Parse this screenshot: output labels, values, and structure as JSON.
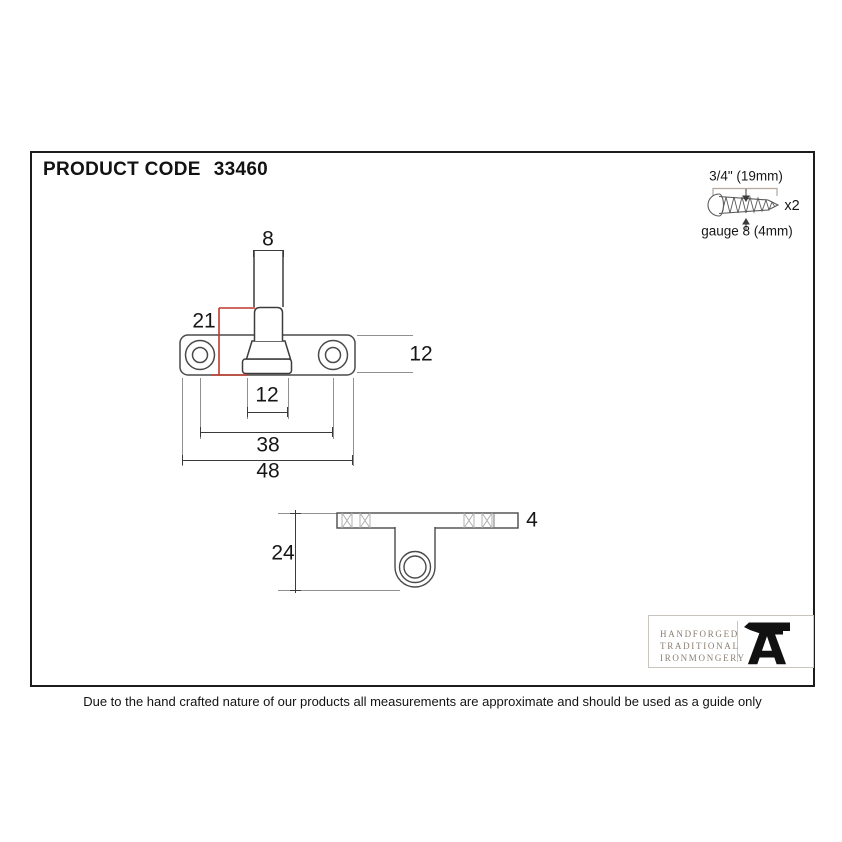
{
  "header": {
    "product_code_label": "PRODUCT CODE",
    "product_code_value": "33460"
  },
  "screw_spec": {
    "length": "3/4\" (19mm)",
    "quantity": "x2",
    "gauge": "gauge 8 (4mm)"
  },
  "views": {
    "top_view": {
      "dims": {
        "pin_width": "8",
        "pin_height": "21",
        "plate_depth": "12",
        "base_width": "12",
        "hole_spacing": "38",
        "plate_width": "48"
      }
    },
    "side_view": {
      "dims": {
        "overall_height": "24",
        "plate_thickness": "4"
      }
    }
  },
  "logo": {
    "line1": "HANDFORGED",
    "line2": "TRADITIONAL",
    "line3": "IRONMONGERY",
    "monogram": "A"
  },
  "footer": {
    "disclaimer": "Due to the hand crafted nature of our products all measurements are approximate and should be used as a guide only"
  },
  "colors": {
    "highlight_red": "#c0392b",
    "line": "#3a3a3a",
    "logo_text": "#8a7e72"
  }
}
